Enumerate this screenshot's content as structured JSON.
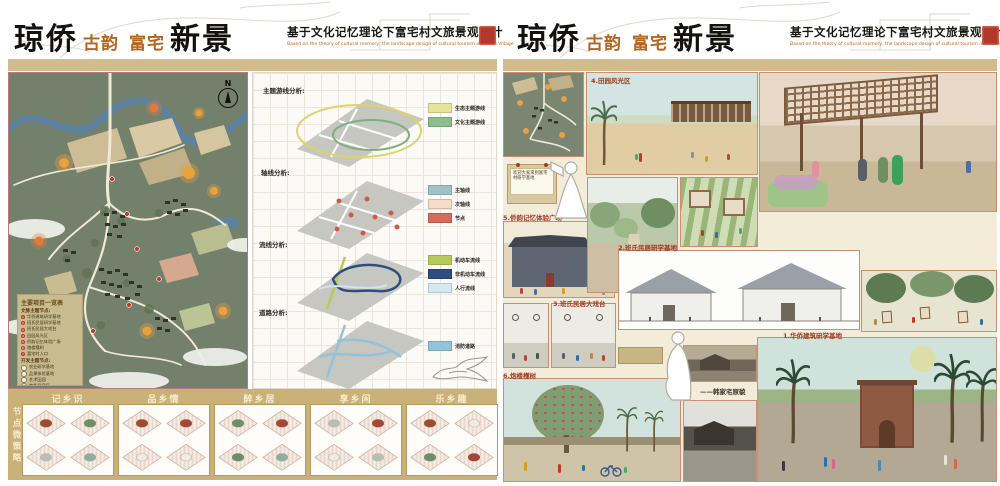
{
  "header": {
    "title": {
      "part1": "琼侨",
      "part2": "古韵",
      "part3": "富宅",
      "part4": "新景"
    },
    "subtitle_cn": "基于文化记忆理论下富宅村文旅景观设计",
    "subtitle_en": "Based on the theory of cultural memory, the landscape design of cultural tourism in Fuzhai Village",
    "accent_color": "#b5651d",
    "seal_color": "#b03a2a"
  },
  "master_plan": {
    "north_label": "N",
    "legend": {
      "title": "主要项目一览表",
      "group1_title": "文脉主题节点:",
      "group1": [
        {
          "num": "1",
          "label": "华侨建筑研学基地"
        },
        {
          "num": "2",
          "label": "班氏民居研学基地"
        },
        {
          "num": "3",
          "label": "班氏民居大戏台"
        },
        {
          "num": "4",
          "label": "田园风光区"
        },
        {
          "num": "5",
          "label": "侨韵记忆体验广场"
        },
        {
          "num": "6",
          "label": "炮楼槿树"
        },
        {
          "num": "7",
          "label": "富宅村入口"
        }
      ],
      "group2_title": "开发主题节点:",
      "group2": [
        {
          "label": "农业研学基地"
        },
        {
          "label": "品果体验基地"
        },
        {
          "label": "艺术田园"
        },
        {
          "label": "特色民宿区"
        },
        {
          "label": "房车营地"
        },
        {
          "label": "拓展体验基地"
        }
      ]
    }
  },
  "analysis": {
    "sections": [
      {
        "label": "主题游线分析:",
        "legend": [
          {
            "name": "生态主题游线",
            "color": "#e6e39b"
          },
          {
            "name": "文化主题游线",
            "color": "#8cbd8c"
          }
        ]
      },
      {
        "label": "轴线分析:",
        "legend": [
          {
            "name": "主轴线",
            "color": "#9ec2c8"
          },
          {
            "name": "次轴线",
            "color": "#f6dcc7"
          },
          {
            "name": "节点",
            "color": "#d86a5a"
          }
        ]
      },
      {
        "label": "流线分析:",
        "legend": [
          {
            "name": "机动车流线",
            "color": "#b6ca5a"
          },
          {
            "name": "非机动车流线",
            "color": "#2e4d7e"
          },
          {
            "name": "人行流线",
            "color": "#d6e9f0"
          }
        ]
      },
      {
        "label": "道路分析:",
        "legend": [
          {
            "name": "消防道路",
            "color": "#93c3da"
          }
        ]
      }
    ]
  },
  "strategies": {
    "side_label": "节点微策略",
    "sections": [
      {
        "title": "记乡识"
      },
      {
        "title": "品乡情"
      },
      {
        "title": "醉乡居"
      },
      {
        "title": "享乡闲"
      },
      {
        "title": "乐乡趣"
      }
    ]
  },
  "renderings": {
    "sign_text": "欢迎大家来到富宅村研学基地",
    "label_1": "1.华侨建筑研学基地",
    "label_2": "2.班氏民居研学基地",
    "label_3": "3.班氏民居大戏台",
    "label_4": "4.田园风光区",
    "label_5": "5.侨韵记忆体验广场",
    "label_6": "6.炮楼槿树",
    "photo_caption": "——韩家宅原貌"
  }
}
